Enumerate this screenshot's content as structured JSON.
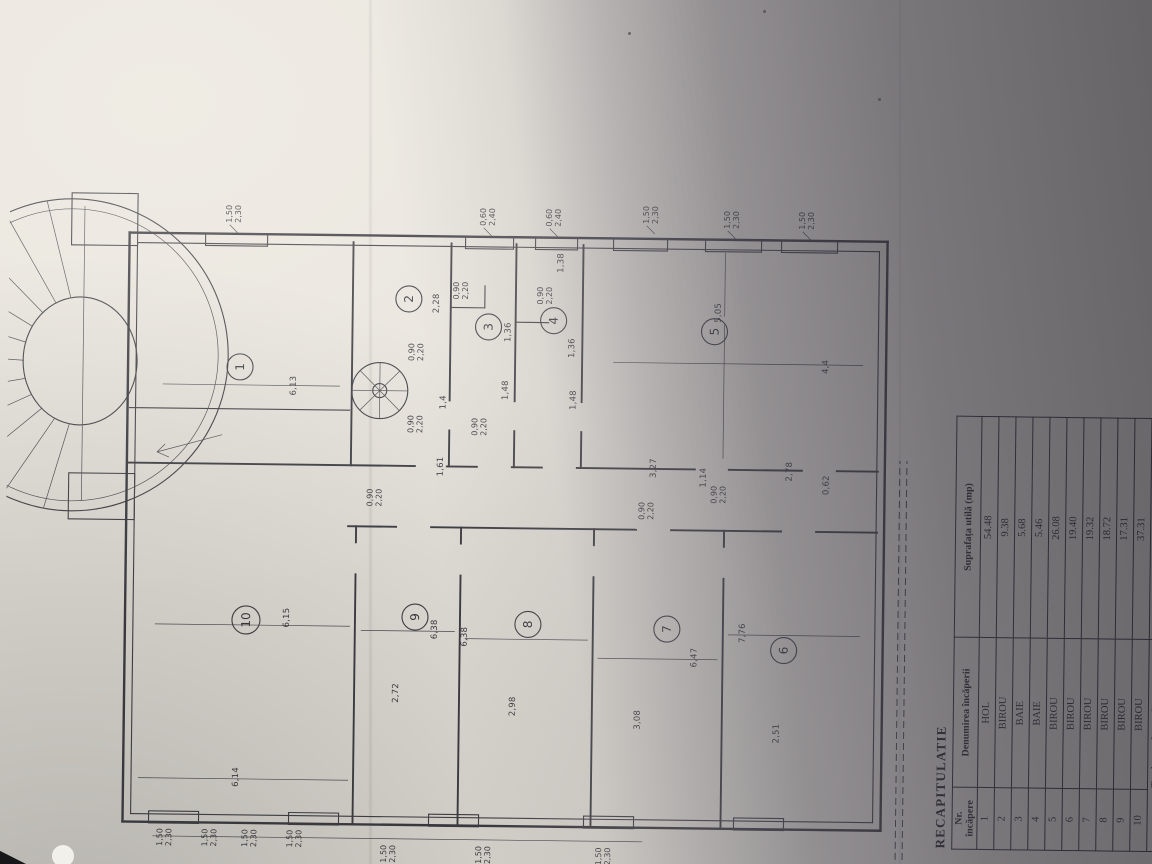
{
  "colors": {
    "paper": "#e9e5de",
    "ink": "#39383e",
    "shadow_side": "#2c2a32"
  },
  "plan": {
    "rooms": [
      "1",
      "2",
      "3",
      "4",
      "5",
      "6",
      "7",
      "8",
      "9",
      "10"
    ],
    "dims": [
      "6,13",
      "2,28",
      "1,36",
      "1,36",
      "1,4",
      "1,48",
      "1,48",
      "5,05",
      "4,4",
      "6,15",
      "6,14",
      "6,38",
      "2,72",
      "6,38",
      "2,98",
      "6,47",
      "3,08",
      "7,76",
      "2,51",
      "1,61",
      "3,27",
      "2,78",
      "0,62",
      "1,14",
      "1,38"
    ],
    "windows": [
      {
        "a": "1,50",
        "b": "2,30"
      },
      {
        "a": "0,60",
        "b": "2,40"
      },
      {
        "a": "0,60",
        "b": "2,40"
      },
      {
        "a": "1,50",
        "b": "2,30"
      },
      {
        "a": "1,50",
        "b": "2,30"
      },
      {
        "a": "1,50",
        "b": "2,30"
      },
      {
        "a": "1,50",
        "b": "2,30"
      },
      {
        "a": "1,50",
        "b": "2,30"
      },
      {
        "a": "1,50",
        "b": "2,30"
      },
      {
        "a": "1,50",
        "b": "2,30"
      },
      {
        "a": "1,50",
        "b": "2,30"
      },
      {
        "a": "1,50",
        "b": "2,30"
      },
      {
        "a": "1,50",
        "b": "2,30"
      }
    ],
    "door": {
      "a": "0,90",
      "b": "2,20"
    }
  },
  "table": {
    "title": "RECAPITULATIE",
    "col1a": "Nr.",
    "col1b": "încăpere",
    "col2": "Denumirea încăperii",
    "col3": "Suprafața utilă (mp)",
    "rows": [
      {
        "nr": "1",
        "name": "HOL",
        "area": "54.48"
      },
      {
        "nr": "2",
        "name": "BIROU",
        "area": "9.38"
      },
      {
        "nr": "3",
        "name": "BAIE",
        "area": "5.68"
      },
      {
        "nr": "4",
        "name": "BAIE",
        "area": "5.46"
      },
      {
        "nr": "5",
        "name": "BIROU",
        "area": "26.08"
      },
      {
        "nr": "6",
        "name": "BIROU",
        "area": "19.40"
      },
      {
        "nr": "7",
        "name": "BIROU",
        "area": "19.32"
      },
      {
        "nr": "8",
        "name": "BIROU",
        "area": "18.72"
      },
      {
        "nr": "9",
        "name": "BIROU",
        "area": "17.31"
      },
      {
        "nr": "10",
        "name": "BIROU",
        "area": "37.31"
      }
    ],
    "total_label": "Total suprafața utilă",
    "total_value": "213.14"
  }
}
